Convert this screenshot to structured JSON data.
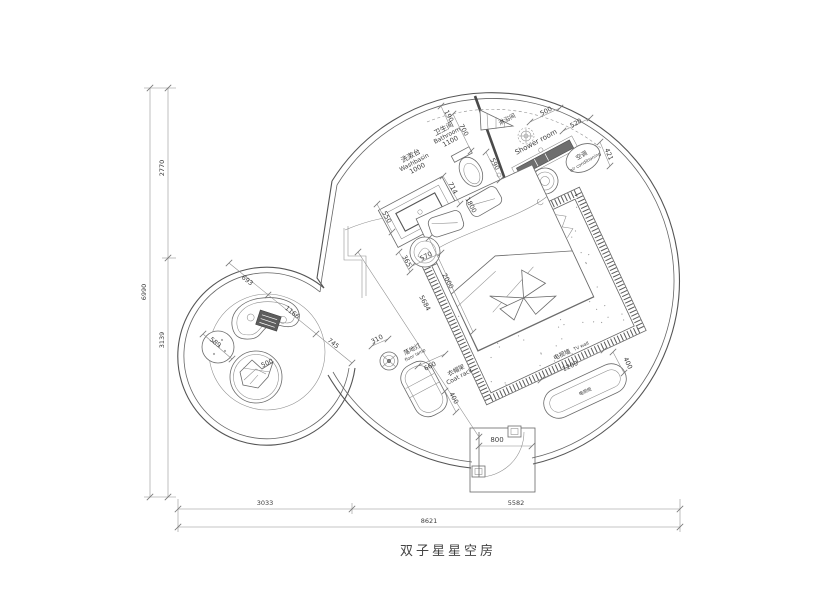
{
  "title": "双子星星空房",
  "rooms": {
    "washbasin_cn": "洗漱台",
    "washbasin_en": "Washbasin",
    "bathroom_cn": "卫生间",
    "bathroom_en": "Bathroom",
    "shower_cn": "淋浴间",
    "shower_en": "Shower room",
    "ac_cn": "空调",
    "ac_en": "air conditioning",
    "tv_wall_cn": "电视墙",
    "tv_wall_en": "TV wall",
    "tv_cabinet": "电视柜",
    "floor_lamp_cn": "落地灯",
    "floor_lamp_en": "floor lamp",
    "coat_rack_cn": "衣帽架",
    "coat_rack_en": "Coat rack"
  },
  "dims": {
    "total_width": "8621",
    "bottom_left": "3033",
    "bottom_right": "5582",
    "total_height": "6990",
    "left_top": "2770",
    "left_bottom": "3139",
    "washbasin_w": "1000",
    "bathroom_w": "1100",
    "basin_depth": "550",
    "d190": "190",
    "d700": "700",
    "shower_w": "500",
    "d520": "520",
    "d421": "421",
    "d590": "590",
    "d714": "714",
    "bed_w": "1800",
    "bed_l": "2000",
    "diag": "5684",
    "stool_a": "365",
    "stool_b": "570",
    "lamp": "310",
    "coat_w": "660",
    "coat_d": "400",
    "tv_w": "1200",
    "tv_d": "400",
    "door": "800",
    "pod_a": "693",
    "pod_b": "1166",
    "pod_c": "745",
    "ottoman": "589",
    "chair": "500"
  }
}
